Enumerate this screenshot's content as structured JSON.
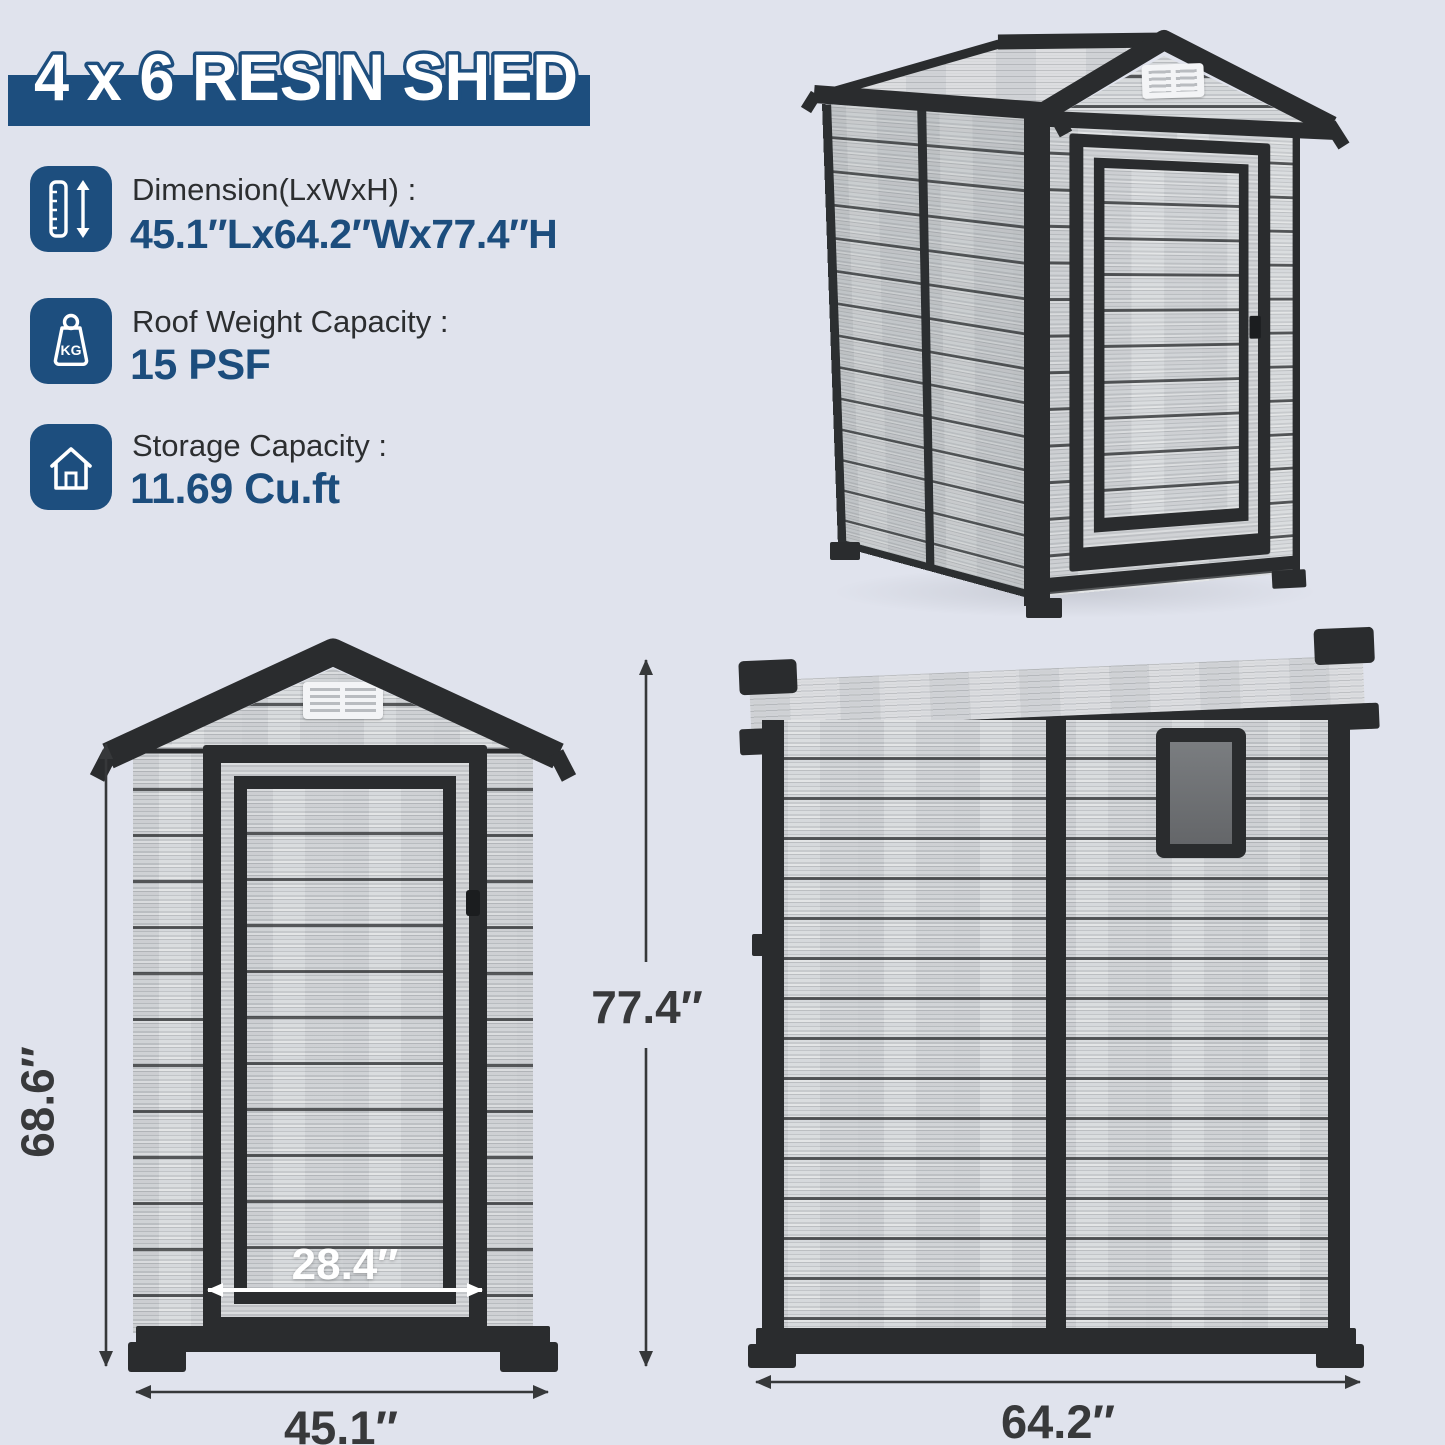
{
  "title": "4 x 6 RESIN SHED",
  "colors": {
    "background": "#e0e3ed",
    "accent_blue": "#1d4e7e",
    "value_blue": "#1c4d7d",
    "trim_dark": "#2a2c2e",
    "dim_text": "#38393b"
  },
  "specs": [
    {
      "icon": "height-ruler-icon",
      "label": "Dimension(LxWxH) :",
      "value": "45.1″Lx64.2″Wx77.4″H"
    },
    {
      "icon": "weight-kg-icon",
      "label": "Roof Weight Capacity :",
      "value": "15 PSF",
      "icon_text": "KG"
    },
    {
      "icon": "house-icon",
      "label": "Storage Capacity :",
      "value": "11.69 Cu.ft"
    }
  ],
  "dimensions": {
    "front_wall_height": "68.6″",
    "overall_height": "77.4″",
    "door_width": "28.4″",
    "front_width": "45.1″",
    "side_width": "64.2″"
  }
}
